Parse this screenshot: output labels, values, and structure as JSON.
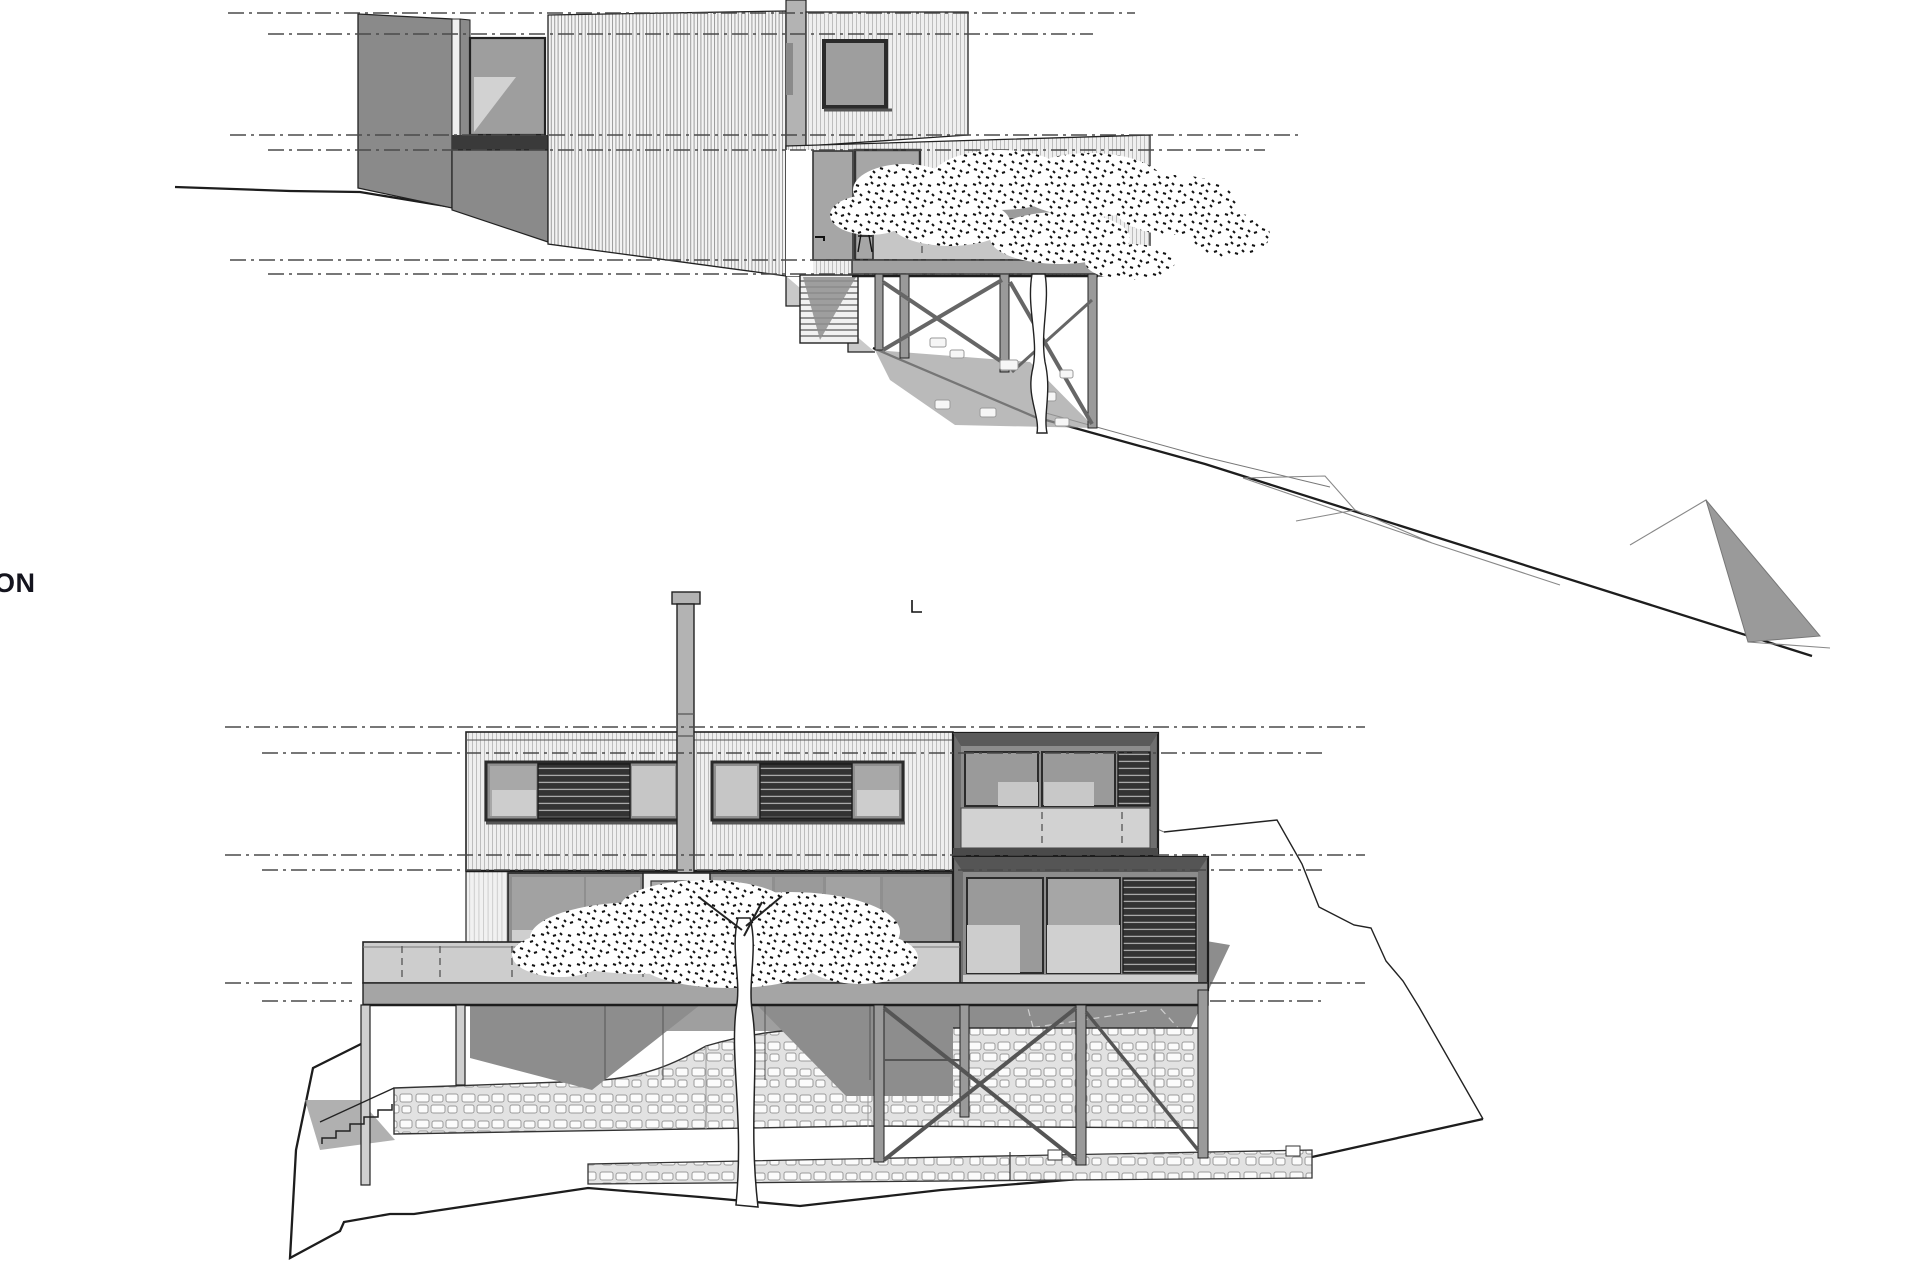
{
  "canvas": {
    "width": 1920,
    "height": 1280,
    "background": "#ffffff"
  },
  "label": {
    "text": "ON"
  },
  "colors": {
    "paper": "#ffffff",
    "ink": "#222222",
    "datum": "#4a4a4a",
    "wallDark": "#8a8a8a",
    "glass": "#9e9e9e",
    "glassLight": "#d2d2d2",
    "panelLight": "#d6d6d6",
    "deck": "#c6c6c6",
    "slab": "#a0a0a0",
    "shadow": "#8d8d8d",
    "louverDark": "#2e2e2e",
    "stoneLine": "#9a9a9a",
    "chimney": "#b3b3b3"
  },
  "upper_elevation": {
    "datum_lines": [
      {
        "y": 13,
        "x1": 228,
        "x2": 1135
      },
      {
        "y": 34,
        "x1": 268,
        "x2": 1093
      },
      {
        "y": 135,
        "x1": 230,
        "x2": 1302
      },
      {
        "y": 150,
        "x1": 268,
        "x2": 1265
      },
      {
        "y": 260,
        "x1": 230,
        "x2": 1100
      },
      {
        "y": 274,
        "x1": 268,
        "x2": 1042
      }
    ]
  },
  "lower_elevation": {
    "datum_lines": [
      {
        "y": 727,
        "x1": 225,
        "x2": 1365
      },
      {
        "y": 753,
        "x1": 262,
        "x2": 1323
      },
      {
        "y": 855,
        "x1": 225,
        "x2": 1365
      },
      {
        "y": 870,
        "x1": 262,
        "x2": 1323
      },
      {
        "y": 983,
        "x1": 225,
        "x2": 352
      },
      {
        "y": 983,
        "x1": 1210,
        "x2": 1365
      },
      {
        "y": 1001,
        "x1": 262,
        "x2": 352
      },
      {
        "y": 1001,
        "x1": 1210,
        "x2": 1323
      }
    ]
  }
}
